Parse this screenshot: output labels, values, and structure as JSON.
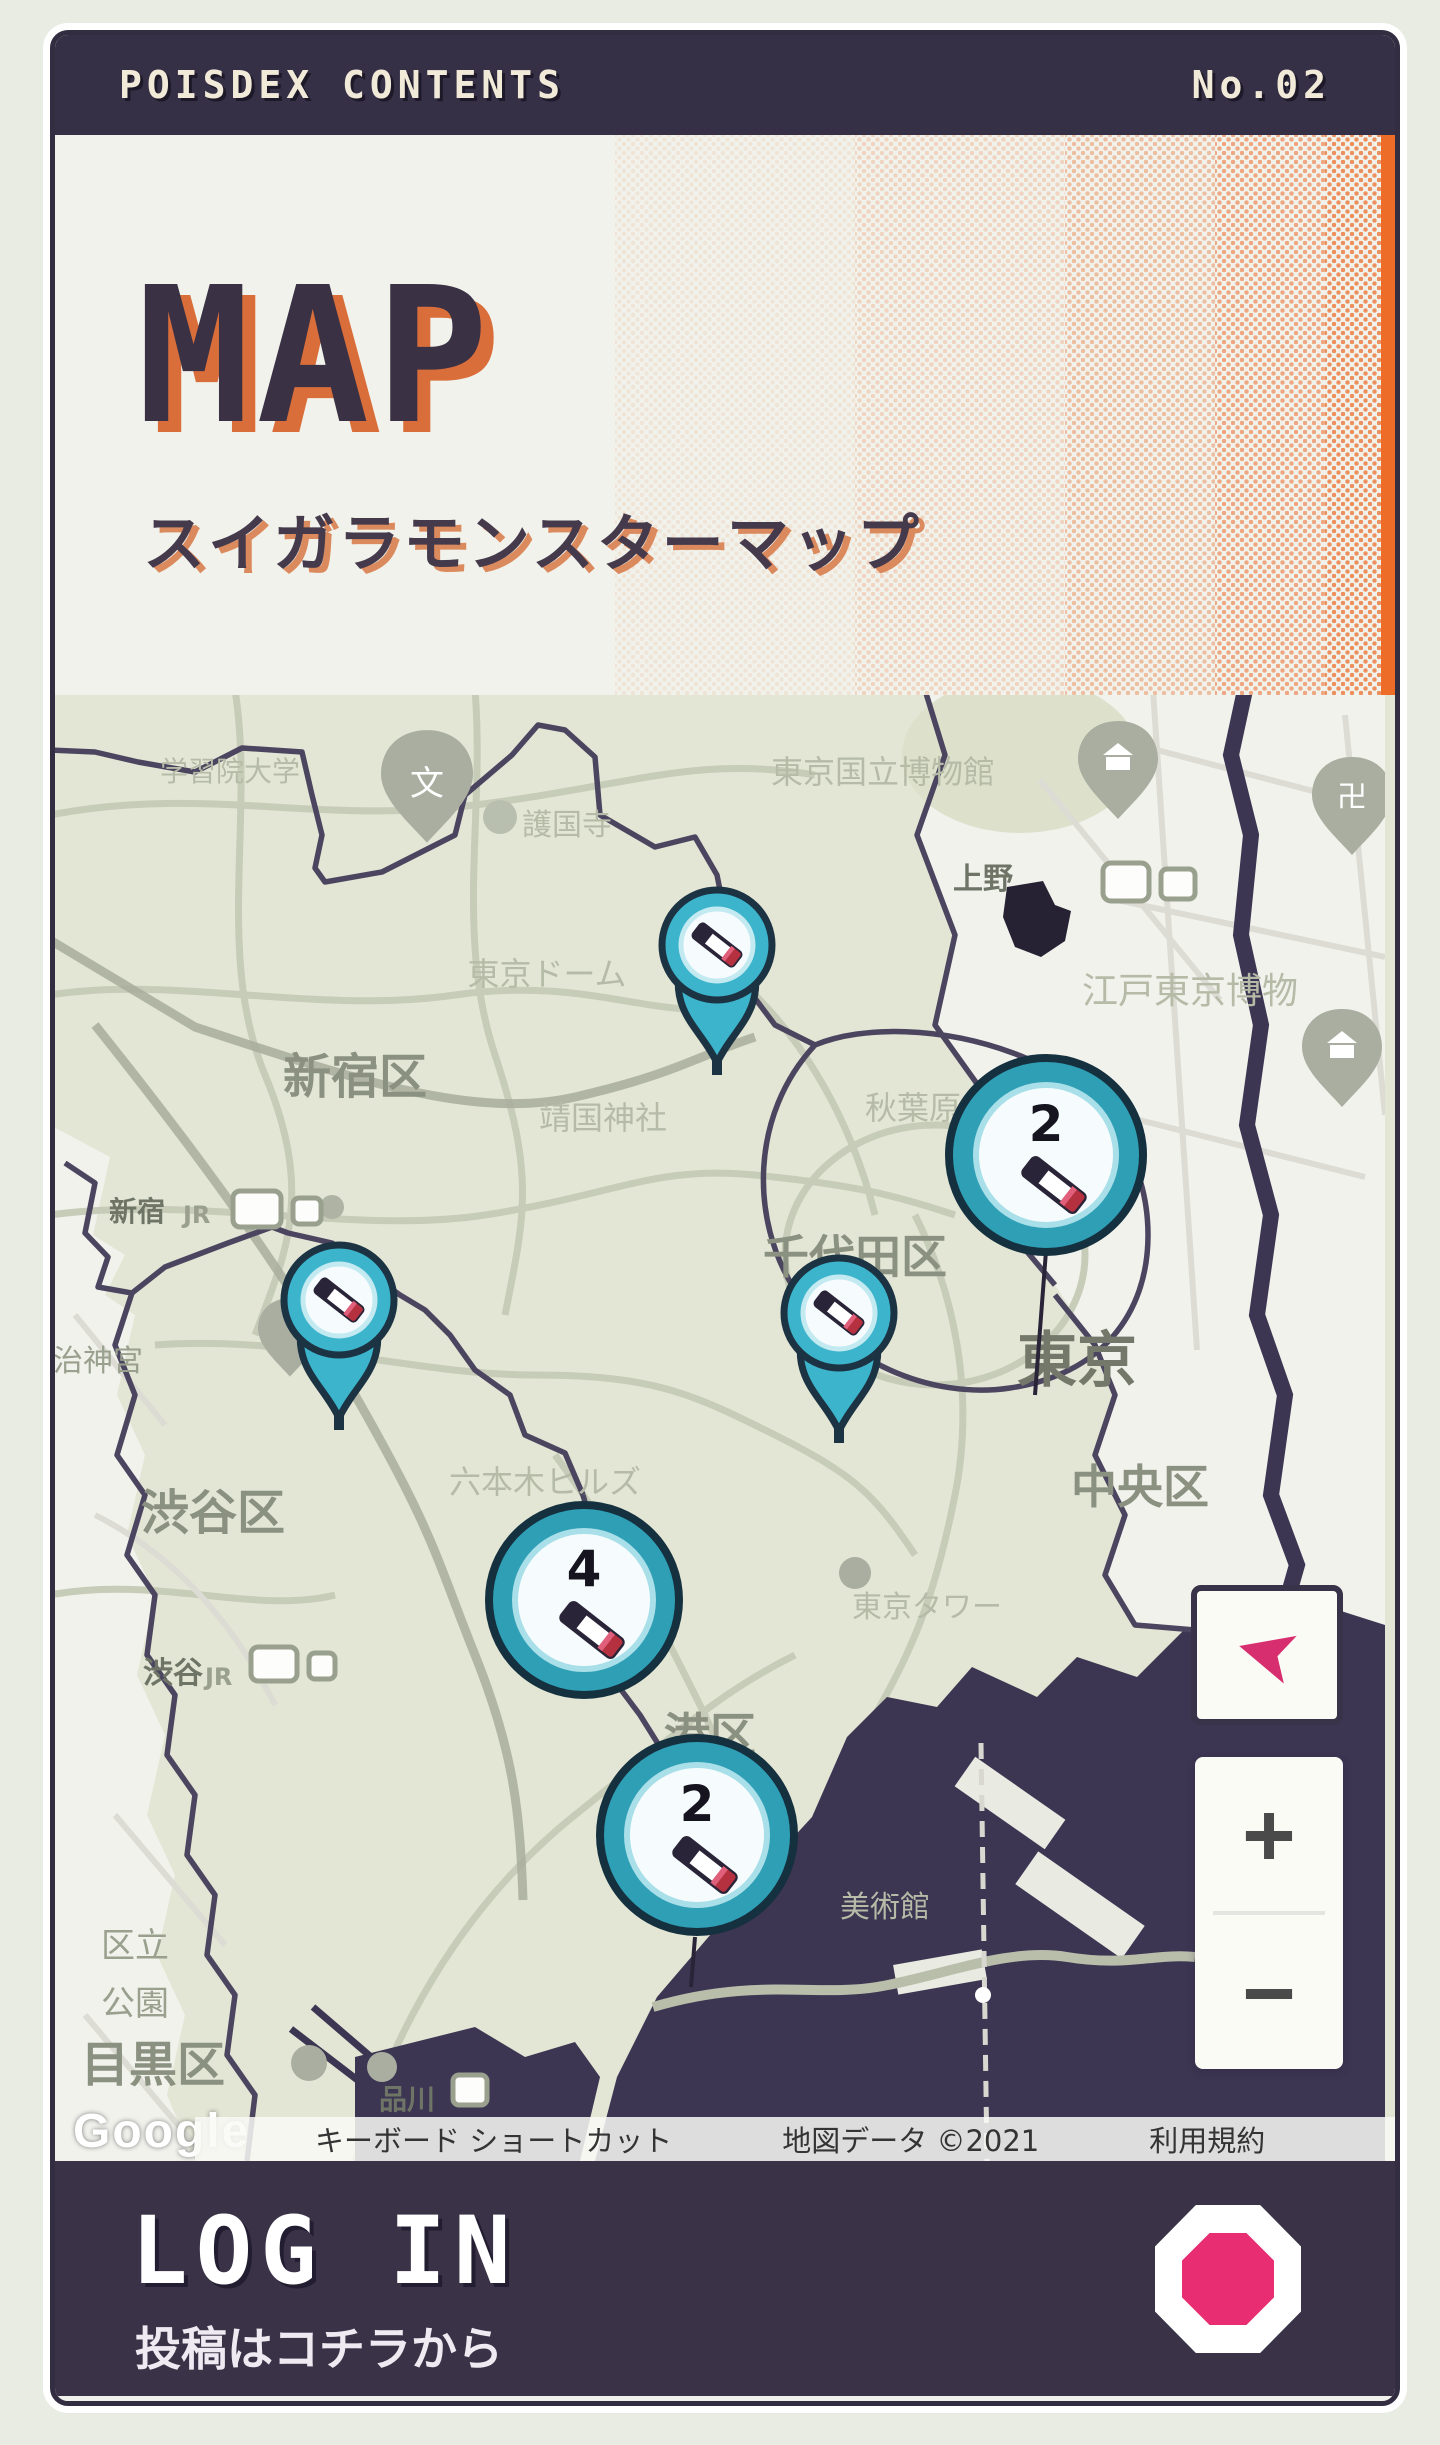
{
  "top_bar": {
    "title": "POISDEX CONTENTS",
    "number": "No.02"
  },
  "header": {
    "title": "MAP",
    "subtitle": "スイガラモンスターマップ",
    "accent_color": "#ec6c28"
  },
  "map": {
    "labels": [
      "学習院大学",
      "護国寺",
      "東京国立博物館",
      "上野",
      "江戸東京博物",
      "東京ドーム",
      "新宿区",
      "靖国神社",
      "秋葉原",
      "千代田区",
      "東京",
      "中央区",
      "明治神宮",
      "渋谷区",
      "六本木ヒルズ",
      "渋谷",
      "港区",
      "東京タワー",
      "美術館",
      "区立",
      "公園",
      "目黒区",
      "品川",
      "新宿"
    ],
    "poi_glyphs": {
      "temple": "卍",
      "school": "文",
      "jr": "JR"
    },
    "clusters": [
      {
        "count": "2"
      },
      {
        "count": "4"
      },
      {
        "count": "2"
      }
    ],
    "pin_colors": {
      "teal": "#3cb4cc",
      "outline": "#1c3343",
      "tip_red": "#b5313f"
    },
    "controls": {
      "compass": "➤",
      "zoom_in": "+",
      "zoom_out": "−"
    },
    "google_logo": "Google",
    "attribution": [
      "キーボード ショートカット",
      "地図データ ©2021",
      "利用規約"
    ]
  },
  "footer": {
    "title": "LOG IN",
    "subtitle": "投稿はコチラから",
    "button_color": "#e82d72"
  }
}
